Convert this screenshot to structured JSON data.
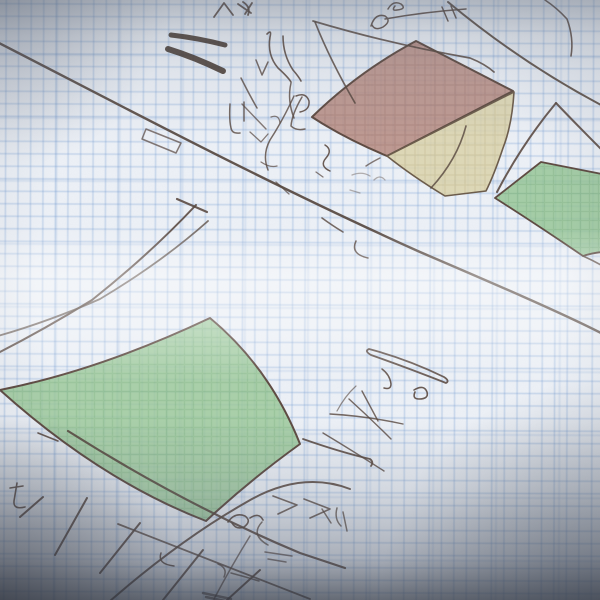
{
  "scene": {
    "description": "hand-drawn pencil sketch on blue graph paper with shaded colored regions, no legible text",
    "canvas": {
      "width": 600,
      "height": 600
    },
    "palette": {
      "paper": "#edf1f7",
      "grid_blue": "#6491cd",
      "pencil": "#55453c",
      "pencil_dark": "#3c2f26",
      "region_red": "#b78a80",
      "region_yellow": "#dcd3aa",
      "region_green_small": "#94c594",
      "region_green_big": "#9bc898",
      "vignette": "#323844"
    },
    "regions": [
      {
        "name": "red-shaded-region",
        "fill": "url(#hatch-red)",
        "opacity": 0.86,
        "stroke": "#5d4a40",
        "sw": 2,
        "d": "M312,117 Q358,72 416,41 L513,91 L387,156 Q344,138 312,117 Z"
      },
      {
        "name": "yellow-shaded-region",
        "fill": "url(#hatch-yellow)",
        "opacity": 0.85,
        "stroke": "#6b5a48",
        "sw": 1.6,
        "d": "M387,156 L514,92 Q512,125 503,148 Q494,175 486,191 L445,196 Q412,176 387,156 Z"
      },
      {
        "name": "green-small-shaded-region",
        "fill": "url(#hatch-green)",
        "opacity": 0.82,
        "stroke": "#5d4a40",
        "sw": 1.8,
        "d": "M495,198 L541,162 L602,174 L602,252 Q592,253 583,256 Q536,224 495,198 Z"
      },
      {
        "name": "green-big-shaded-region",
        "fill": "url(#hatch-green2)",
        "opacity": 0.82,
        "stroke": "#5d4a40",
        "sw": 2,
        "d": "M0,390 Q100,370 210,318 Q270,368 300,444 Q250,480 206,521 Q100,480 0,390 Z"
      }
    ],
    "strokes": [
      {
        "name": "main-diagonal-line",
        "w": 2.4,
        "o": 0.92,
        "d": "M-3,42 C120,105 260,180 420,252 C490,282 560,312 603,334"
      },
      {
        "name": "topright-diagonal-line",
        "w": 2,
        "o": 0.9,
        "d": "M448,2 Q520,62 601,105"
      },
      {
        "name": "peak-left-leg",
        "w": 2,
        "d": "M497,192 Q522,144 556,103"
      },
      {
        "name": "peak-right-leg",
        "w": 2,
        "d": "M556,103 Q576,124 601,149"
      },
      {
        "name": "lowerleft-line-a",
        "w": 2,
        "d": "M196,205 Q150,254 92,300 Q45,329 -2,353"
      },
      {
        "name": "lowerleft-line-b",
        "w": 1.8,
        "o": 0.75,
        "d": "M208,221 Q162,262 100,299 Q50,321 -2,336"
      },
      {
        "name": "lowerleft-crossbar",
        "w": 2.2,
        "d": "M177,199 L207,212"
      },
      {
        "name": "small-box-outline",
        "w": 1.5,
        "o": 0.7,
        "d": "M146,129 L181,143 L176,153 L142,139 Z"
      },
      {
        "name": "yellow-inner-curve",
        "w": 1.6,
        "o": 0.8,
        "d": "M466,126 Q457,160 431,188"
      },
      {
        "name": "green-small-tail",
        "w": 1.6,
        "d": "M583,256 Q592,260 601,265"
      },
      {
        "name": "red-under-tail",
        "w": 1.5,
        "o": 0.7,
        "d": "M380,158 Q372,162 366,166"
      },
      {
        "name": "bottom-line-a1",
        "w": 2.2,
        "d": "M68,431 Q185,505 300,553 L345,568"
      },
      {
        "name": "bottom-line-a2",
        "w": 1.8,
        "o": 0.8,
        "d": "M118,524 Q215,562 310,599"
      },
      {
        "name": "bottom-line-b",
        "w": 2,
        "d": "M350,489 Q300,470 245,503 Q180,540 110,601"
      },
      {
        "name": "green-big-tail-curve",
        "w": 1.8,
        "d": "M303,439 Q340,452 370,459 Q374,462 371,466"
      },
      {
        "name": "hatch-tick-1",
        "w": 2,
        "d": "M20,517 L43,497"
      },
      {
        "name": "hatch-tick-2",
        "w": 2,
        "d": "M55,555 L87,498"
      },
      {
        "name": "hatch-tick-3",
        "w": 2,
        "d": "M100,573 L140,523"
      },
      {
        "name": "hatch-tick-4",
        "w": 2,
        "d": "M163,600 L203,550"
      },
      {
        "name": "hatch-tick-5",
        "w": 2,
        "d": "M227,600 L260,570"
      },
      {
        "name": "corner-squiggle",
        "w": 1.6,
        "d": "M10,488 L23,486 M17,483 L14,501 Q13,510 25,507"
      },
      {
        "name": "dash-on-line-a",
        "w": 1.6,
        "d": "M38,433 L58,441"
      },
      {
        "name": "crossing-chevrons",
        "w": 1.6,
        "o": 0.8,
        "d": "M273,496 L297,505 L278,514 M304,499 L330,509 L310,518"
      },
      {
        "name": "crossing-squiggles",
        "w": 1.5,
        "o": 0.75,
        "d": "M262,522 Q250,535 268,545 M218,564 Q228,568 224,577 M231,573 Q246,577 259,581"
      },
      {
        "name": "crossing-dash-pair",
        "w": 1.5,
        "o": 0.7,
        "d": "M265,552 L292,556 M268,559 L286,562"
      },
      {
        "name": "crossing-hook",
        "w": 1.5,
        "d": "M161,553 Q157,564 174,566"
      },
      {
        "name": "green-tip-loops",
        "w": 1.6,
        "d": "M228,522 Q235,512 245,516 Q252,521 244,527 Q236,530 232,523 M250,518 Q259,512 263,520"
      },
      {
        "name": "steep-scratch",
        "w": 1.5,
        "o": 0.7,
        "d": "M250,536 Q232,565 214,599"
      },
      {
        "name": "bottom-smudge",
        "w": 2.5,
        "o": 0.6,
        "c": "#3c2f26",
        "d": "M203,593 L231,599 M206,597 L225,601"
      },
      {
        "name": "below-cluster-marks",
        "w": 1.5,
        "o": 0.75,
        "d": "M322,509 L331,523 M337,508 Q334,519 341,526 M347,531 L343,512"
      },
      {
        "name": "cigar-outline",
        "w": 1.8,
        "d": "M369,349 Q407,359 444,377 Q450,381 446,383 Q408,368 371,355 Q364,351 369,349 Z"
      },
      {
        "name": "cigar-squiggle",
        "w": 1.6,
        "d": "M414,390 Q424,384 427,392 Q429,399 419,399 Q412,399 415,392"
      },
      {
        "name": "cigar-hook",
        "w": 1.5,
        "d": "M382,369 Q390,375 391,384 Q391,390 384,388"
      },
      {
        "name": "fan-stroke-1",
        "w": 1.4,
        "o": 0.8,
        "d": "M362,391 Q370,406 378,421"
      },
      {
        "name": "fan-stroke-2",
        "w": 1.4,
        "o": 0.8,
        "d": "M330,414 Q366,416 403,424"
      },
      {
        "name": "fan-stroke-3",
        "w": 1.4,
        "o": 0.8,
        "d": "M349,399 Q370,418 391,439"
      },
      {
        "name": "fan-stroke-4",
        "w": 1.4,
        "o": 0.8,
        "d": "M323,433 Q353,451 384,471"
      },
      {
        "name": "fan-spur",
        "w": 1.2,
        "o": 0.6,
        "d": "M337,411 Q345,396 356,386"
      },
      {
        "name": "thick-bar-1",
        "w": 5,
        "o": 0.85,
        "c": "#3c2f26",
        "d": "M171,35 Q198,38 225,45"
      },
      {
        "name": "thick-bar-2",
        "w": 6,
        "o": 0.85,
        "c": "#3c2f26",
        "d": "M168,49 Q194,57 223,71"
      },
      {
        "name": "caret-marks",
        "w": 1.8,
        "d": "M214,17 L224,3 L233,15 M238,4 L251,13 M245,14 L252,3"
      },
      {
        "name": "corner-mark",
        "w": 1.8,
        "d": "M243,2 Q251,7 248,15"
      },
      {
        "name": "vertical-squiggle-pair",
        "w": 1.6,
        "d": "M267,34 Q272,29 270,37 Q267,55 278,68 Q288,77 291,82 M283,36 Q283,55 293,70 Q299,77 301,81"
      },
      {
        "name": "vertical-continuation",
        "w": 1.5,
        "o": 0.8,
        "d": "M291,83 Q287,100 294,118"
      },
      {
        "name": "left-diag-marks",
        "w": 1.5,
        "o": 0.8,
        "d": "M241,78 Q249,94 257,108 M256,60 L262,75 L268,62"
      },
      {
        "name": "hook-j",
        "w": 1.5,
        "d": "M296,96 Q306,92 309,101 Q310,110 300,112"
      },
      {
        "name": "hooks-pair",
        "w": 1.5,
        "o": 0.8,
        "d": "M230,104 Q229,120 231,128 Q232,134 240,133 M244,102 L244,121"
      },
      {
        "name": "diag-dash",
        "w": 1.4,
        "o": 0.7,
        "d": "M242,104 L266,129"
      },
      {
        "name": "long-sweep-curve",
        "w": 1.7,
        "o": 0.85,
        "d": "M313,21 Q390,44 470,58 Q485,64 494,72"
      },
      {
        "name": "steep-stroke",
        "w": 1.7,
        "o": 0.85,
        "d": "M315,22 Q330,60 355,103"
      },
      {
        "name": "top-squiggle",
        "w": 1.5,
        "d": "M388,9 Q393,0 401,4 Q407,9 397,10 Q391,11 395,6"
      },
      {
        "name": "alpha-loop",
        "w": 1.5,
        "d": "M371,26 Q375,13 385,16 Q392,21 383,27 Q375,31 372,25 M385,19 Q424,12 466,9"
      },
      {
        "name": "short-pair",
        "w": 1.5,
        "d": "M442,7 L448,21 M451,6 L456,18"
      },
      {
        "name": "topright-corner-stroke",
        "w": 1.6,
        "d": "M545,0 Q557,8 567,19 Q574,38 571,56"
      },
      {
        "name": "e-squiggle-1",
        "w": 1.5,
        "o": 0.8,
        "d": "M294,96 Q283,120 270,140 Q262,155 268,170"
      },
      {
        "name": "e-squiggle-2",
        "w": 1.5,
        "o": 0.8,
        "d": "M302,97 Q292,114 291,126 Q296,131 305,129"
      },
      {
        "name": "small-hook",
        "w": 1.3,
        "o": 0.7,
        "d": "M271,117 Q279,114 280,123"
      },
      {
        "name": "angular-mark",
        "w": 1.3,
        "o": 0.7,
        "d": "M250,132 L261,142 L268,134"
      },
      {
        "name": "misc-small-marks",
        "w": 1.3,
        "o": 0.7,
        "d": "M261,162 Q270,168 277,166 M316,172 L323,177 M276,182 L289,194"
      },
      {
        "name": "zeta-squiggle",
        "w": 1.5,
        "d": "M325,145 Q333,150 326,158 Q319,166 330,171"
      },
      {
        "name": "under-line-squiggle",
        "w": 1.5,
        "d": "M356,241 Q350,254 368,258"
      },
      {
        "name": "on-line-dash",
        "w": 1.6,
        "o": 0.8,
        "d": "M322,218 Q333,226 343,232"
      },
      {
        "name": "faint-mid-scribbles",
        "w": 1.3,
        "o": 0.4,
        "d": "M352,175 Q362,171 370,176 M374,180 Q380,174 385,180 M350,190 L360,193"
      }
    ]
  }
}
